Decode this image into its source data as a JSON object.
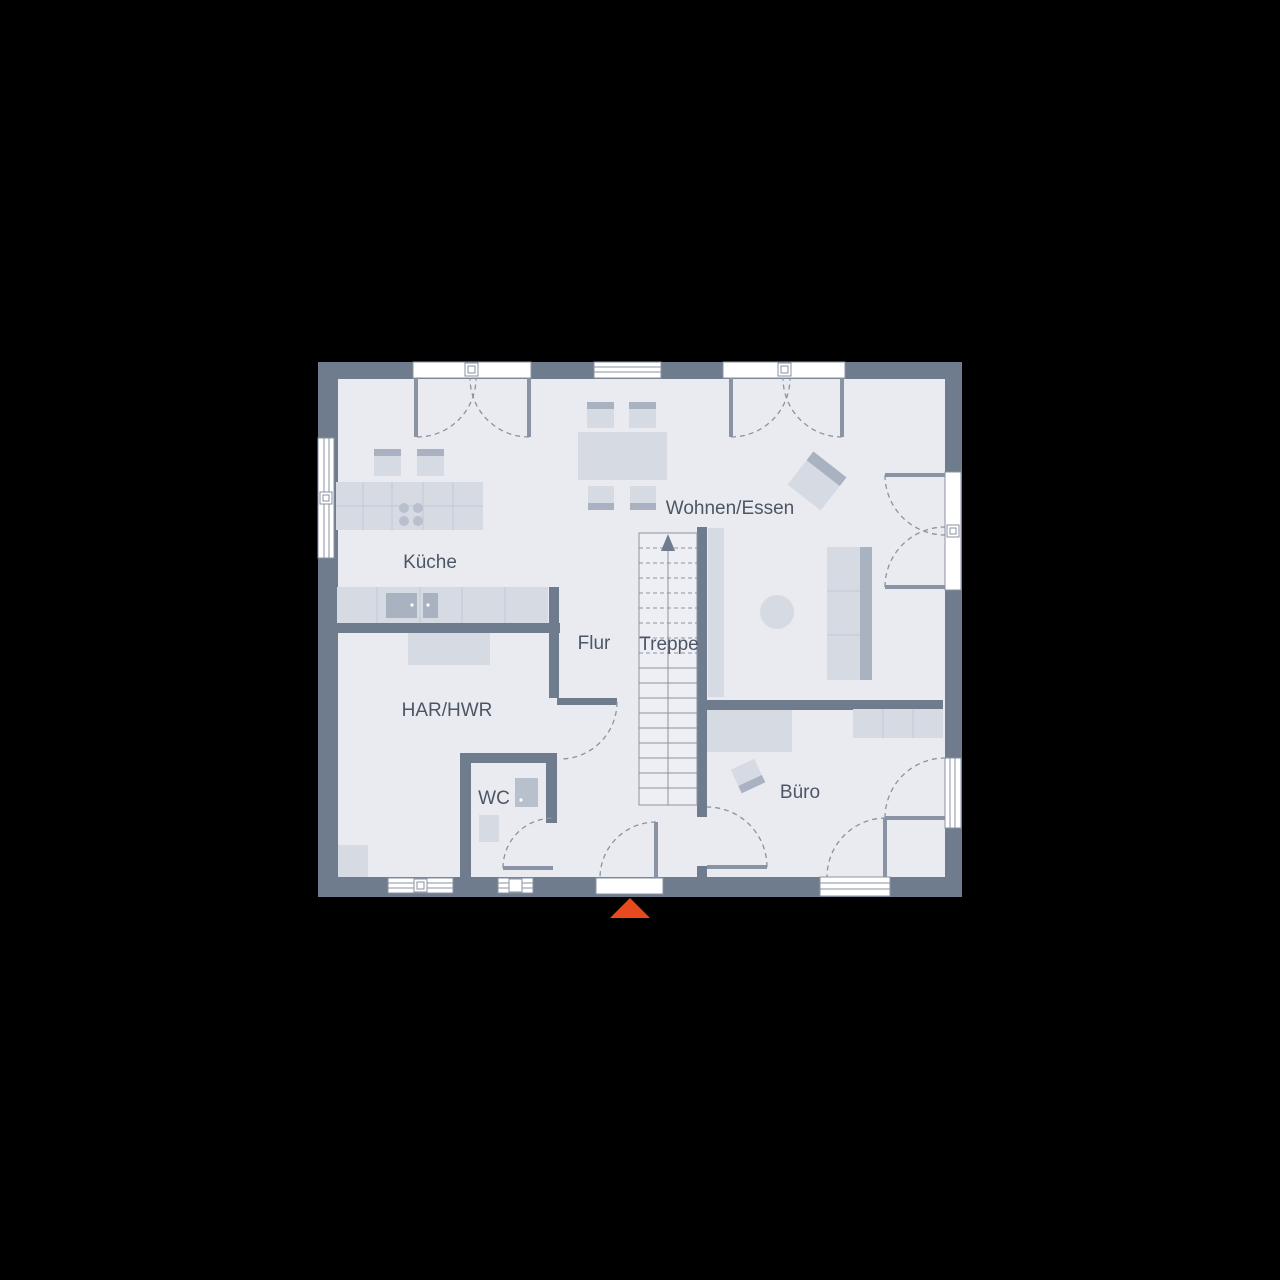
{
  "title": "Ground floor plan",
  "rooms": {
    "kueche": "Küche",
    "wohnen_essen": "Wohnen/Essen",
    "flur": "Flur",
    "treppe": "Treppe",
    "har_hwr": "HAR/HWR",
    "wc": "WC",
    "buero": "Büro"
  },
  "icons": {
    "entrance_marker": "entrance-direction-triangle",
    "stairs_arrow": "stairs-up-arrow"
  },
  "colors": {
    "background": "#000000",
    "wall": "#6f7c8d",
    "floor": "#e9ebf1",
    "stairs": "#edeff4",
    "furniture": "#d6dae3",
    "furnitureDark": "#a9b2c1",
    "furnitureMid": "#b9c0cd",
    "furnitureLine": "#c3c9d5",
    "line": "#8a93a3",
    "window": "#ffffff",
    "label": "#4d5664",
    "entranceMarker": "#e8491d"
  }
}
